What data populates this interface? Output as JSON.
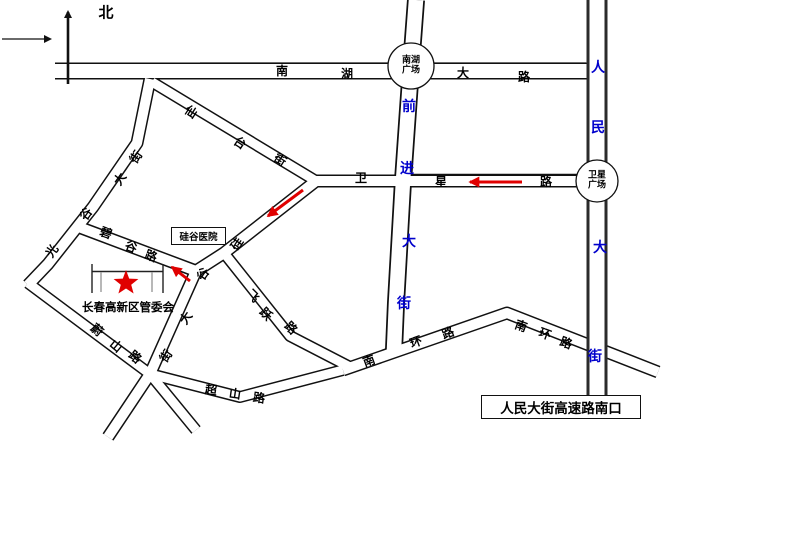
{
  "compass": {
    "north_label": "北"
  },
  "roads": {
    "nanhu_dalu": {
      "name": "南湖大路",
      "chars": [
        "南",
        "湖",
        "大",
        "路"
      ]
    },
    "renmin_dajie": {
      "name": "人民大街",
      "chars": [
        "人",
        "民",
        "大",
        "街"
      ]
    },
    "qianjin_dajie": {
      "name": "前进大街",
      "chars": [
        "前",
        "进",
        "大",
        "街"
      ]
    },
    "weixing_lu": {
      "name": "卫星路",
      "chars": [
        "卫",
        "星",
        "路"
      ]
    },
    "xiantai_jie": {
      "name": "仙台街",
      "chars": [
        "仙",
        "台",
        "街"
      ]
    },
    "guanggu_dajie": {
      "name": "光谷大街",
      "chars": [
        "光",
        "谷",
        "大",
        "街"
      ]
    },
    "bigu_lu": {
      "name": "碧谷路",
      "chars": [
        "碧",
        "谷",
        "路"
      ]
    },
    "guigu_dajie": {
      "name": "硅谷大街",
      "chars": [
        "硅",
        "谷",
        "大",
        "街"
      ]
    },
    "feiyue_lu": {
      "name": "飞跃路",
      "chars": [
        "飞",
        "跃",
        "路"
      ]
    },
    "weishan_lu": {
      "name": "蔚山路",
      "chars": [
        "蔚",
        "山",
        "路"
      ]
    },
    "chaoshan_lu": {
      "name": "超山路",
      "chars": [
        "超",
        "山",
        "路"
      ]
    },
    "nanhuan_lu_west": {
      "name": "南环路",
      "chars": [
        "南",
        "环",
        "路"
      ]
    },
    "nanhuan_lu_east": {
      "name": "南环路",
      "chars": [
        "南",
        "环",
        "路"
      ]
    }
  },
  "plazas": {
    "nanhu_guangchang": {
      "line1": "南湖",
      "line2": "广场"
    },
    "weixing_guangchang": {
      "line1": "卫星",
      "line2": "广场"
    }
  },
  "landmarks": {
    "hospital": "硅谷医院",
    "committee": "长春高新区管委会",
    "highway_exit": "人民大街高速路南口"
  },
  "colors": {
    "road_label_blue": "#0000cc",
    "route_arrow_red": "#e00000",
    "star_red": "#e00000",
    "road_line_black": "#111111"
  }
}
